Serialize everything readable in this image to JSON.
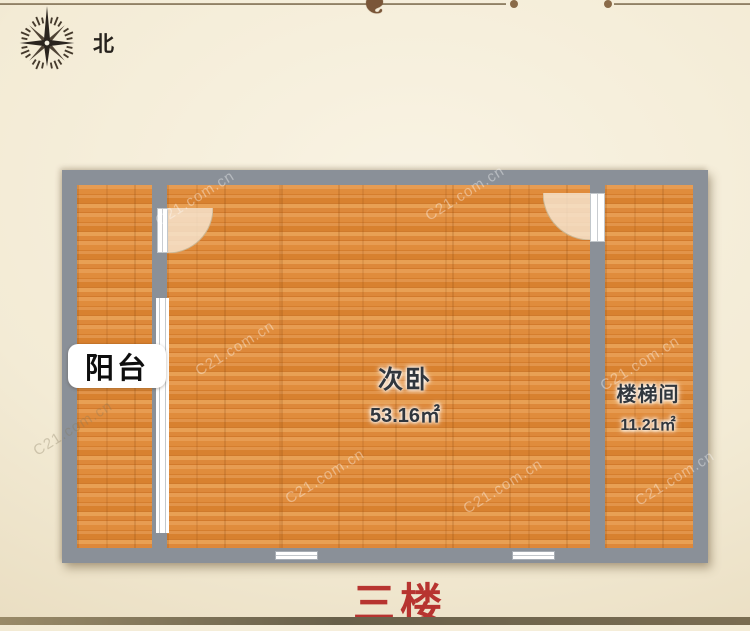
{
  "page": {
    "compass_label": "北",
    "floor_title": "三楼",
    "watermark": "C21.com.cn",
    "ornament": "❦"
  },
  "colors": {
    "floor_wood": "#dd8a3c",
    "wall_gray": "#8a9098",
    "accent_red": "#b73430",
    "background_cream": "#f3ebd5",
    "label_text": "#31373e"
  },
  "floor_plan": {
    "rooms": [
      {
        "name": "阳台",
        "area": ""
      },
      {
        "name": "次卧",
        "area": "53.16㎡"
      },
      {
        "name": "楼梯间",
        "area": "11.21㎡"
      }
    ]
  }
}
